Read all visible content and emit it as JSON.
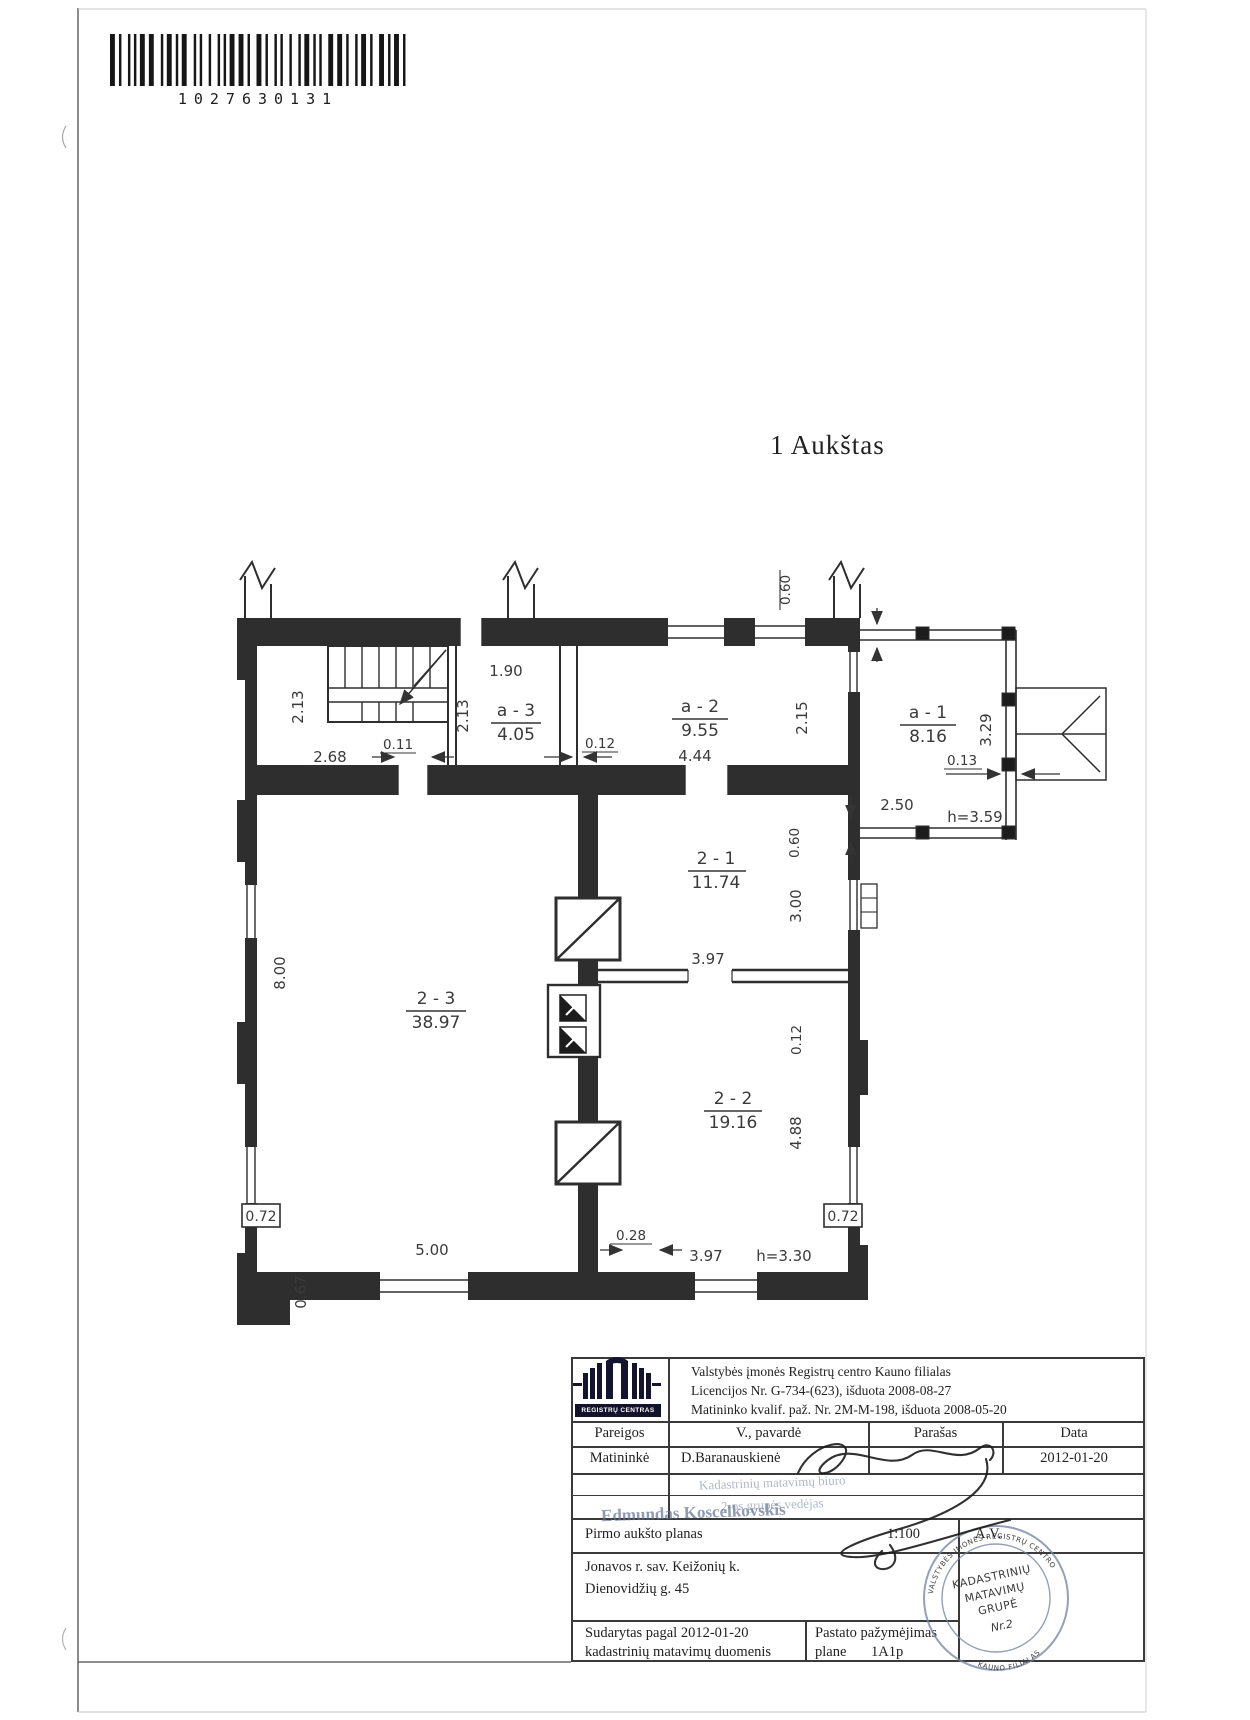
{
  "page": {
    "barcode_number": "1027630131",
    "floor_title": "1 Aukštas"
  },
  "plan": {
    "rooms": {
      "a1": {
        "id": "a - 1",
        "area": "8.16"
      },
      "a2": {
        "id": "a - 2",
        "area": "9.55"
      },
      "a3": {
        "id": "a - 3",
        "area": "4.05"
      },
      "r21": {
        "id": "2 - 1",
        "area": "11.74"
      },
      "r22": {
        "id": "2 - 2",
        "area": "19.16"
      },
      "r23": {
        "id": "2 - 3",
        "area": "38.97"
      }
    },
    "dims": {
      "w190": "1.90",
      "h213a": "2.13",
      "h213b": "2.13",
      "w011": "0.11",
      "w268": "2.68",
      "w012": "0.12",
      "w444": "4.44",
      "h215": "2.15",
      "h060top": "0.60",
      "w250": "2.50",
      "w013": "0.13",
      "h329": "3.29",
      "h359": "h=3.59",
      "h060": "0.60",
      "h300": "3.00",
      "w397a": "3.97",
      "h012": "0.12",
      "h800": "8.00",
      "h488": "4.88",
      "w072l": "0.72",
      "w072r": "0.72",
      "w500": "5.00",
      "w028": "0.28",
      "w397b": "3.97",
      "h330": "h=3.30",
      "h067": "0.67"
    }
  },
  "title_block": {
    "logo_text": "REGISTRŲ CENTRAS",
    "org_line1": "Valstybės įmonės Registrų centro Kauno filialas",
    "org_line2": "Licencijos Nr. G-734-(623), išduota 2008-08-27",
    "org_line3": "Matininko kvalif. paž. Nr. 2M-M-198, išduota 2008-05-20",
    "col_pareigos": "Pareigos",
    "col_pavarde": "V., pavardė",
    "col_parasas": "Parašas",
    "col_data": "Data",
    "row_pareigos": "Matininkė",
    "row_pavarde": "D.Baranauskienė",
    "row_data": "2012-01-20",
    "ghost_line1": "Kadastrinių matavimų biuro",
    "ghost_line2": "2-os grupės vedėjas",
    "ghost_line3": "Edmundas Koscelkovskis",
    "plan_title": "Pirmo aukšto planas",
    "scale": "1:100",
    "av": "A.V.",
    "address_line1": "Jonavos r. sav. Keižonių k.",
    "address_line2": "Dienovidžių g. 45",
    "prepared_line1": "Sudarytas pagal  2012-01-20",
    "prepared_line2": "kadastrinių matavimų duomenis",
    "marking_label1": "Pastato pažymėjimas",
    "marking_label2": "plane",
    "marking_value": "1A1p",
    "stamp": {
      "arc_top": "VALSTYBĖS ĮMONĖS REGISTRŲ CENTRO",
      "line1": "KADASTRINIŲ",
      "line2": "MATAVIMŲ",
      "line3": "GRUPĖ",
      "line4": "Nr.2",
      "arc_bottom": "KAUNO FILIALAS"
    }
  }
}
